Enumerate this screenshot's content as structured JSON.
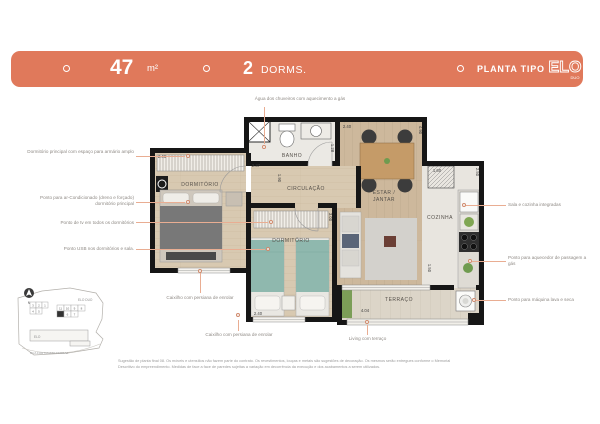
{
  "banner": {
    "area_value": "47",
    "area_unit": "m²",
    "dorms_value": "2",
    "dorms_label": "DORMS.",
    "plan_label": "PLANTA TIPO",
    "logo_text": "ELO",
    "logo_sub": "DUO",
    "color": "#E0795B"
  },
  "callouts": {
    "top": "Água dos chuveiros com aquecimento a gás",
    "left": [
      "Dormitório principal com espaço para armário amplo",
      "Ponto para ar-Condicionado (dreno e forçado) dormitório principal",
      "Ponto de tv em todos os dormitórios",
      "Ponto USB nos dormitórios e sala."
    ],
    "right": [
      "Sala e cozinha integradas",
      "Ponto para aquecedor de passagem a gás",
      "Ponto para máquina lava e seca"
    ],
    "bottom_left": "Caixilho com persiana de enrolar",
    "bottom_center": "Caixilho com persiana de enrolar",
    "bottom_right": "Living com terraço"
  },
  "rooms": {
    "dorm1": "DORMITÓRIO",
    "banho": "BANHO",
    "circulacao": "CIRCULAÇÃO",
    "estar_line1": "ESTAR /",
    "estar_line2": "JANTAR",
    "cozinha": "COZINHA",
    "dorm2": "DORMITÓRIO",
    "terraco": "TERRAÇO"
  },
  "dimensions": {
    "dorm1_w": "2.46",
    "banho_w": "2.37",
    "banho_h": "1.28",
    "estar_w": "2.40",
    "estar_h": "4.90",
    "circ_h": "1.90",
    "cozinha_w": "1.60",
    "cozinha_h": "2.50",
    "dorm2_h": "3.00",
    "dorm2_w": "2.40",
    "terraco_w": "4.04",
    "terraco_h": "1.50"
  },
  "keyplan": {
    "project": "ELO DUO",
    "tower": "ELO",
    "street": "RUA FORTUNATO FERRAZ",
    "north": "N",
    "units": [
      "3",
      "2",
      "1",
      "4",
      "5",
      "11",
      "10",
      "9",
      "8",
      "6",
      "7"
    ]
  },
  "disclaimer": {
    "line1": "Sugestão de planta final 08. Os móveis e utensílios não fazem parte do contrato. Os revestimentos, louças e metais são sugestões de decoração. Os mesmos serão entregues conforme o Memorial",
    "line2": "Descritivo do empreendimento. Medidas de face a face de paredes sujeitas a variação em decorrência da execução e dos acabamentos a serem utilizados."
  }
}
